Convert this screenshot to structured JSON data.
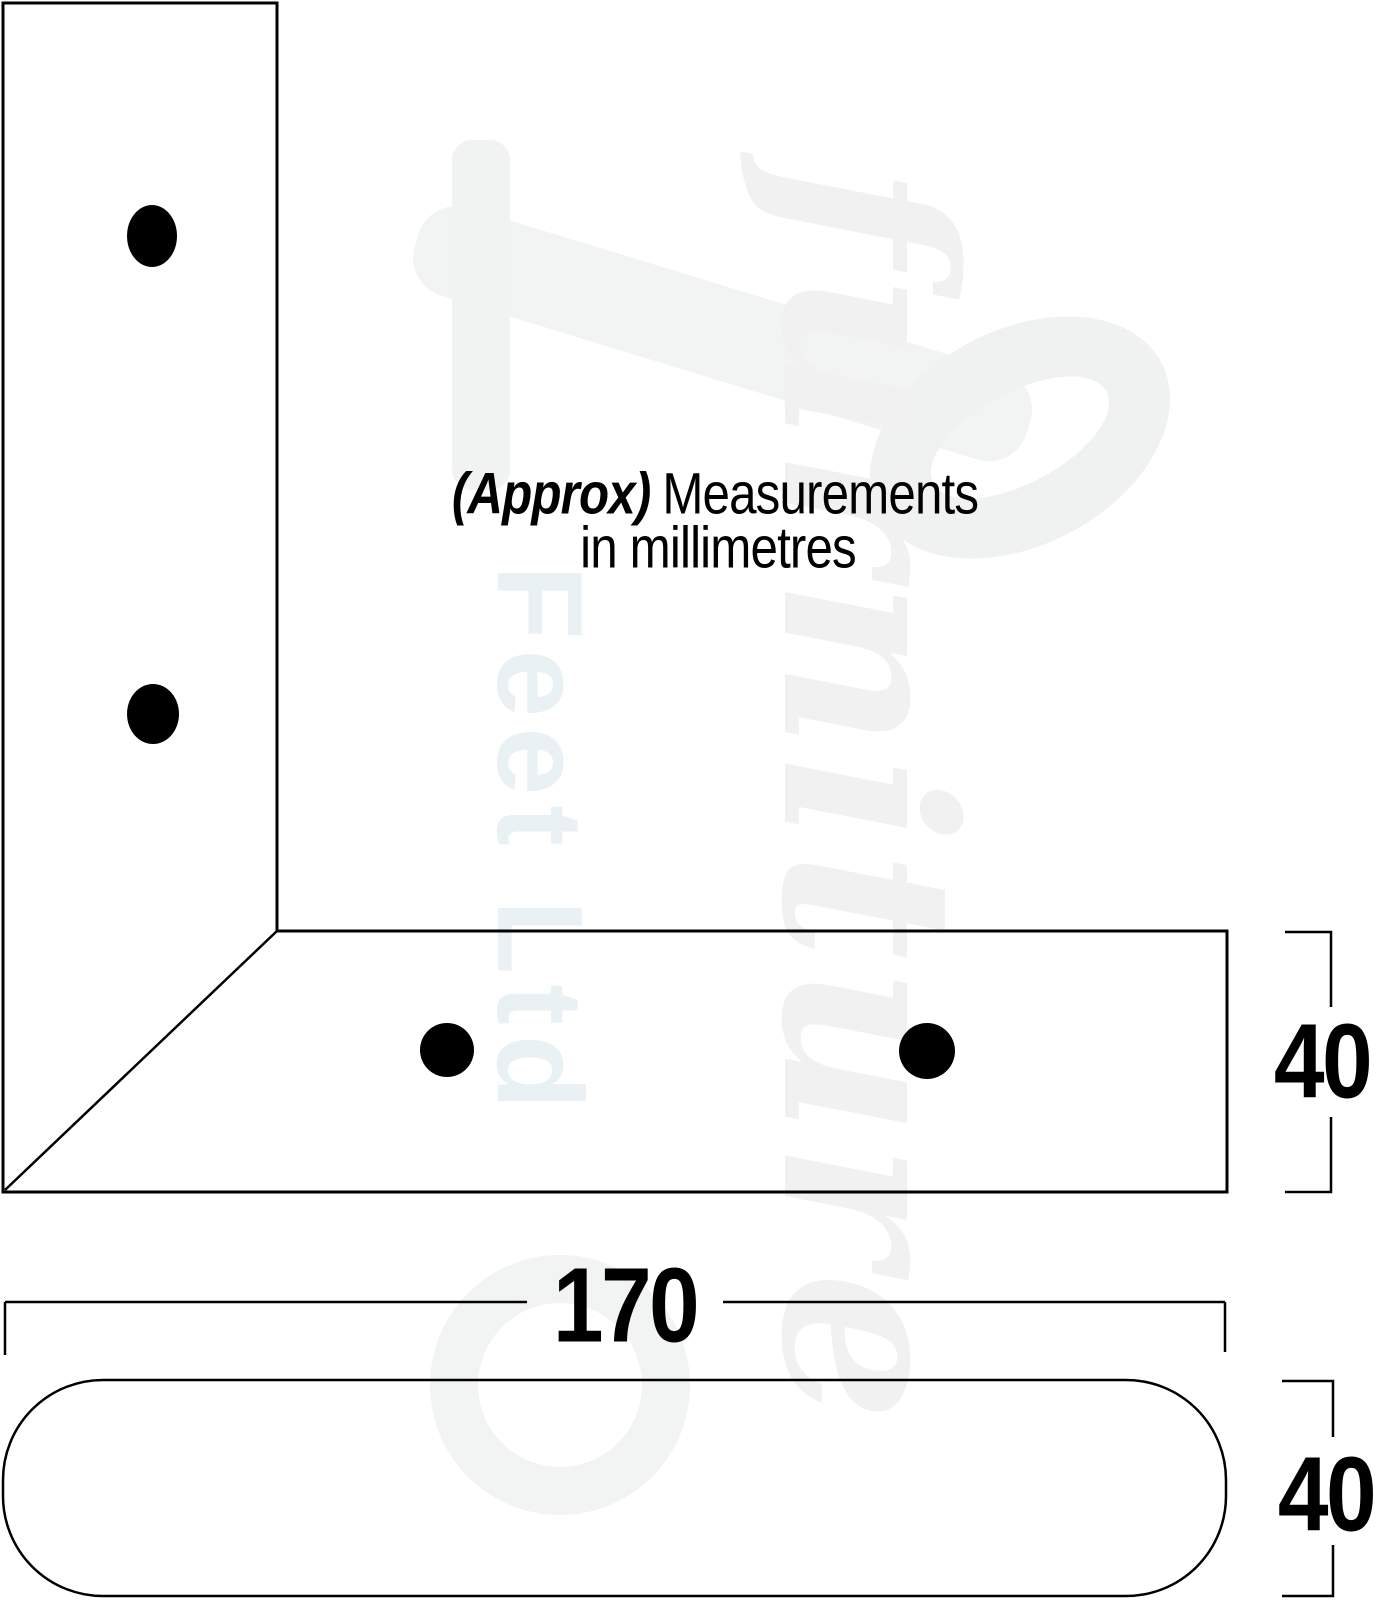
{
  "note": {
    "emphasis": "(Approx)",
    "rest": "Measurements",
    "line2": "in millimetres"
  },
  "dimensions": {
    "bracket_arm_height": "40",
    "base_length": "170",
    "base_height": "40"
  },
  "watermark": {
    "word1": "furniture",
    "word2": "Feet Ltd"
  },
  "colors": {
    "line": "#000000",
    "hole_fill": "#000000",
    "watermark_gray": "#f1f1f1",
    "watermark_blue": "#eaf1f4"
  }
}
